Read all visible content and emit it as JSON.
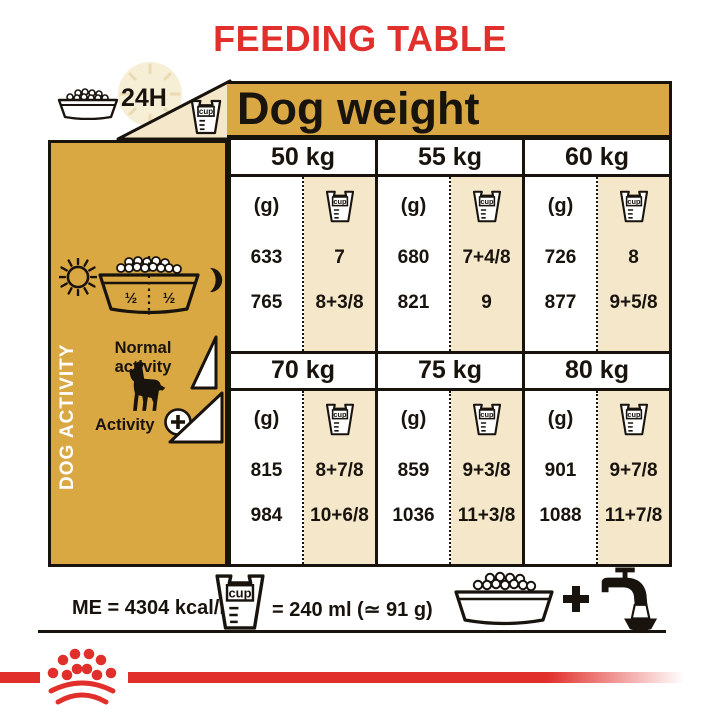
{
  "title": "FEEDING TABLE",
  "header": {
    "duration": "24H",
    "dog_weight": "Dog weight",
    "cup_label": "cup"
  },
  "sidebar": {
    "vertical_label": "DOG ACTIVITY",
    "normal_activity": "Normal activity",
    "activity_plus": "Activity",
    "bowl_half_left": "½",
    "bowl_half_right": "½"
  },
  "table": {
    "grams_label": "(g)",
    "cup_label": "cup",
    "groups": [
      {
        "weights": [
          "50 kg",
          "55 kg",
          "60 kg"
        ],
        "columns": [
          {
            "g": [
              "633",
              "765"
            ],
            "cup": [
              "7",
              "8+3/8"
            ]
          },
          {
            "g": [
              "680",
              "821"
            ],
            "cup": [
              "7+4/8",
              "9"
            ]
          },
          {
            "g": [
              "726",
              "877"
            ],
            "cup": [
              "8",
              "9+5/8"
            ]
          }
        ]
      },
      {
        "weights": [
          "70 kg",
          "75 kg",
          "80 kg"
        ],
        "columns": [
          {
            "g": [
              "815",
              "984"
            ],
            "cup": [
              "8+7/8",
              "10+6/8"
            ]
          },
          {
            "g": [
              "859",
              "1036"
            ],
            "cup": [
              "9+3/8",
              "11+3/8"
            ]
          },
          {
            "g": [
              "901",
              "1088"
            ],
            "cup": [
              "9+7/8",
              "11+7/8"
            ]
          }
        ]
      }
    ]
  },
  "footer": {
    "energy": "ME = 4304 kcal/kg",
    "cup_label": "cup",
    "cup_equivalence": "= 240 ml (≃ 91 g)",
    "plus": "+"
  },
  "icons": {
    "clock": "clock-face",
    "kibble_bowl": "bowl-with-kibble",
    "cup": "measuring-cup",
    "sun": "sun",
    "moon": "crescent-moon",
    "dog": "dog-silhouette",
    "triangle_ramp": "activity-ramp-triangle",
    "plus_circle": "circled-plus",
    "faucet": "water-tap-with-bowl",
    "crown": "royal-canin-crown-logo"
  },
  "colors": {
    "gold": "#d9a843",
    "cream": "#f4e7ca",
    "red": "#e1302c",
    "ink": "#19130d"
  },
  "chart_data": {
    "type": "table",
    "title": "FEEDING TABLE",
    "column_header": "Dog weight",
    "weights_kg": [
      50,
      55,
      60,
      70,
      75,
      80
    ],
    "units": [
      "g",
      "cup"
    ],
    "rows": [
      {
        "name": "Normal activity",
        "g": [
          633,
          680,
          726,
          815,
          859,
          901
        ],
        "cup": [
          "7",
          "7+4/8",
          "8",
          "8+7/8",
          "9+3/8",
          "9+7/8"
        ]
      },
      {
        "name": "Activity +",
        "g": [
          765,
          821,
          877,
          984,
          1036,
          1088
        ],
        "cup": [
          "8+3/8",
          "9",
          "9+5/8",
          "10+6/8",
          "11+3/8",
          "11+7/8"
        ]
      }
    ],
    "notes": [
      "ME = 4304 kcal/kg",
      "cup = 240 ml (≃ 91 g)",
      "feed half ration morning (sun) and half evening (moon), over 24H, with water"
    ]
  }
}
